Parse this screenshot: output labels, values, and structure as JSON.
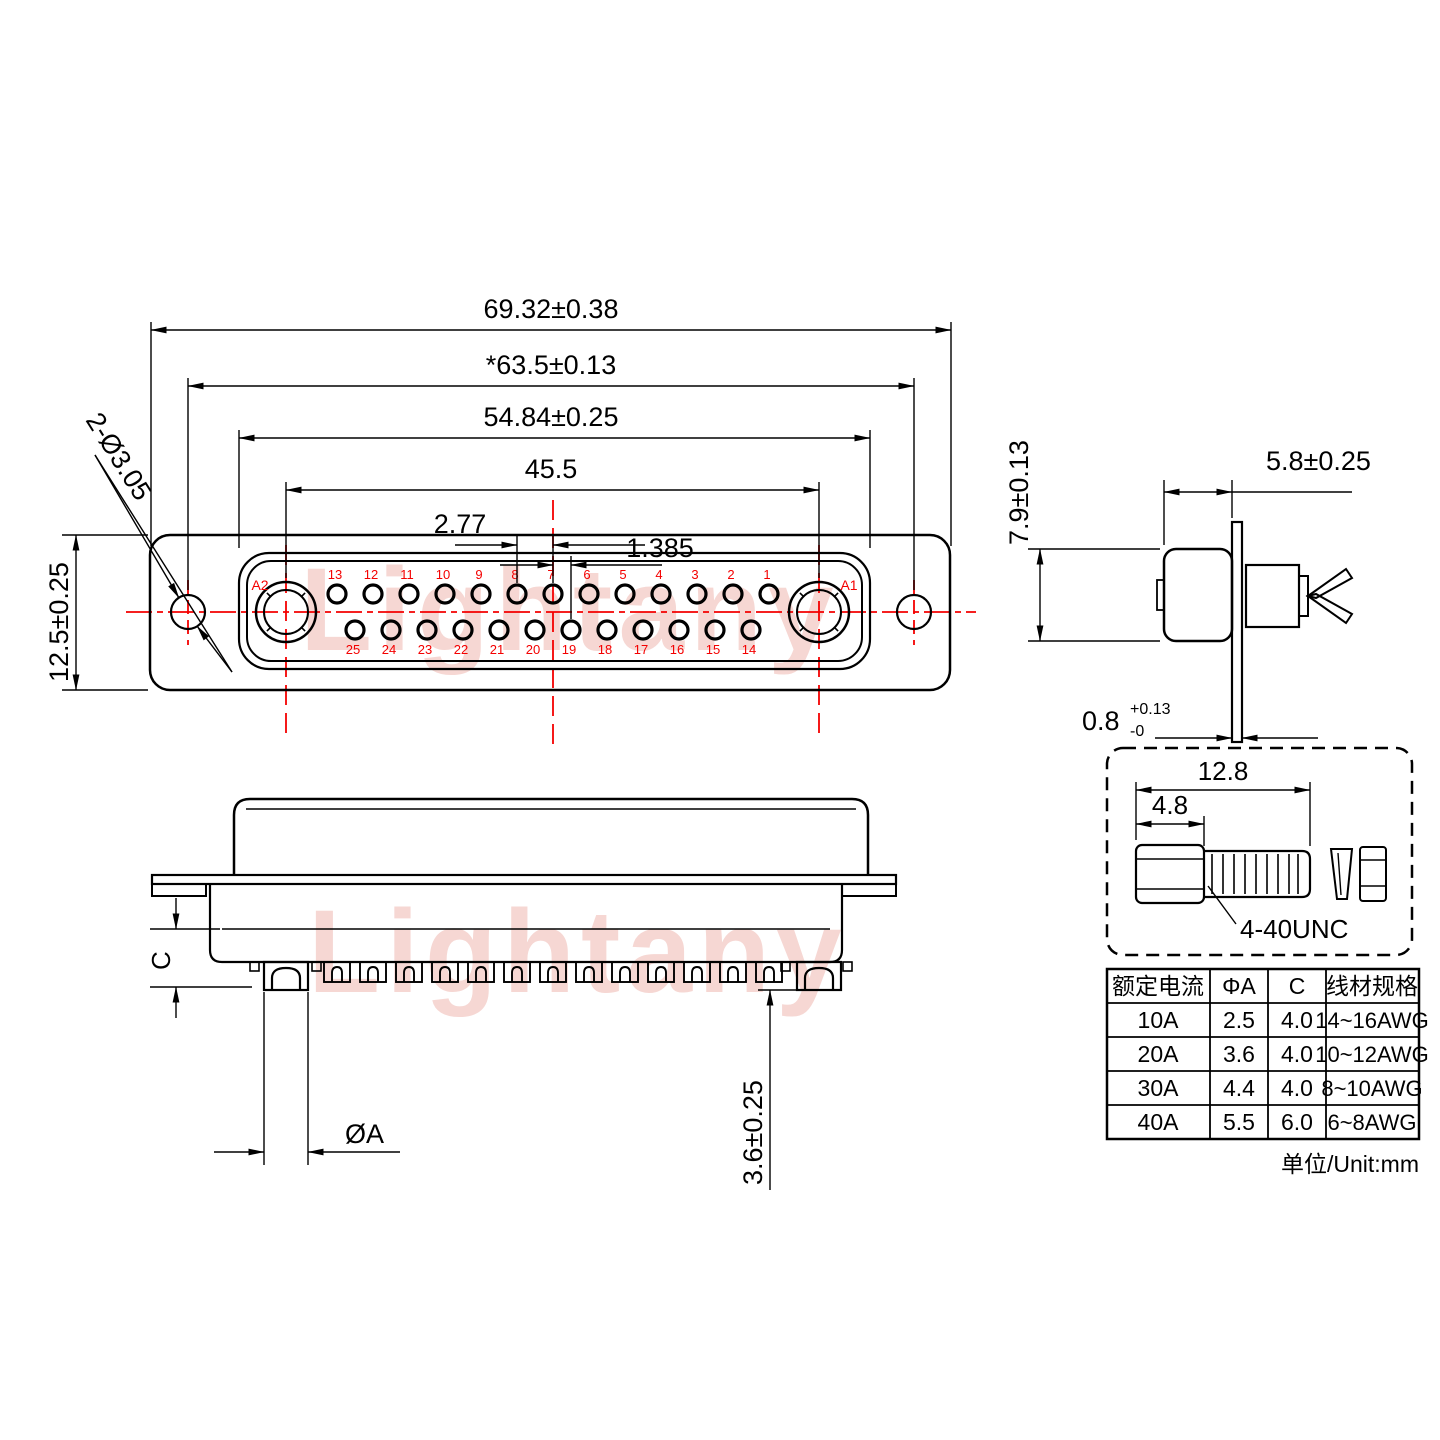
{
  "watermark": {
    "text": "Lightany"
  },
  "front_view": {
    "coax_left_label": "A2",
    "coax_right_label": "A1",
    "top_row_labels": [
      "13",
      "12",
      "11",
      "10",
      "9",
      "8",
      "7",
      "6",
      "5",
      "4",
      "3",
      "2",
      "1"
    ],
    "bottom_row_labels": [
      "25",
      "24",
      "23",
      "22",
      "21",
      "20",
      "19",
      "18",
      "17",
      "16",
      "15",
      "14"
    ],
    "dims": {
      "overall_width": "69.32±0.38",
      "mount_hole_span": "*63.5±0.13",
      "shell_width": "54.84±0.25",
      "contact_span": "45.5",
      "pin_pitch": "2.77",
      "row_offset": "1.385",
      "mount_hole": "2-Ø3.05",
      "flange_height": "12.5±0.25"
    }
  },
  "side_view": {
    "dims": {
      "body_height": "7.9±0.13",
      "shell_depth": "5.8±0.25",
      "flange_thickness": "0.8",
      "flange_tol_plus": "+0.13",
      "flange_tol_minus": "-0"
    }
  },
  "screw_detail": {
    "dims": {
      "overall_length": "12.8",
      "head_length": "4.8"
    },
    "thread_label": "4-40UNC"
  },
  "section_view": {
    "dims": {
      "cup_depth_label": "C",
      "cup_diameter_label": "ØA",
      "tail_length": "3.6±0.25"
    }
  },
  "spec_table": {
    "headers": [
      "额定电流",
      "ΦA",
      "C",
      "线材规格"
    ],
    "rows": [
      [
        "10A",
        "2.5",
        "4.0",
        "14~16AWG"
      ],
      [
        "20A",
        "3.6",
        "4.0",
        "10~12AWG"
      ],
      [
        "30A",
        "4.4",
        "4.0",
        "8~10AWG"
      ],
      [
        "40A",
        "5.5",
        "6.0",
        "6~8AWG"
      ]
    ],
    "units_note": "单位/Unit:mm"
  },
  "colors": {
    "line": "#000000",
    "accent_red": "#f40000",
    "watermark_pink": "#f6d7d3"
  }
}
